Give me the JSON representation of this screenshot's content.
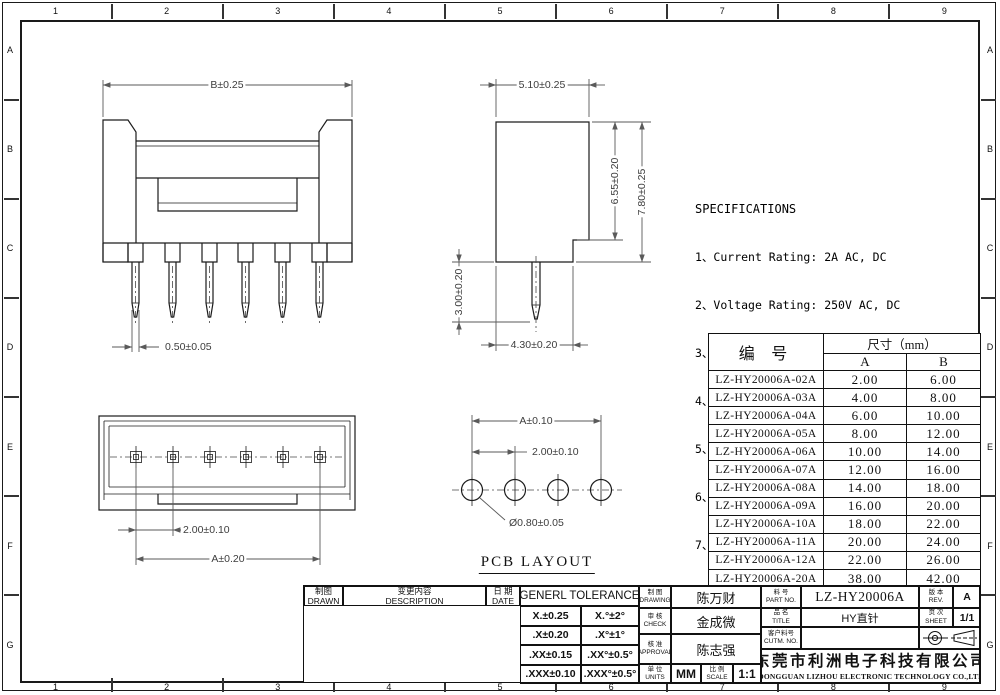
{
  "sheet": {
    "grid": {
      "columns": [
        "1",
        "2",
        "3",
        "4",
        "5",
        "6",
        "7",
        "8",
        "9"
      ],
      "rows": [
        "A",
        "B",
        "C",
        "D",
        "E",
        "F",
        "G"
      ]
    }
  },
  "views": {
    "front_view": {
      "dims": {
        "body_width": "B±0.25",
        "pin_width": "0.50±0.05"
      }
    },
    "side_view": {
      "dims": {
        "body_depth": "5.10±0.25",
        "inner_height": "6.55±0.20",
        "overall_height": "7.80±0.25",
        "pin_length": "3.00±0.20",
        "base_depth": "4.30±0.20"
      }
    },
    "top_view": {
      "dims": {
        "pin_pitch": "2.00±0.10",
        "pin_span": "A±0.20"
      }
    },
    "pcb_layout": {
      "label": "PCB LAYOUT",
      "dims": {
        "hole_span": "A±0.10",
        "hole_pitch": "2.00±0.10",
        "hole_diameter": "Ø0.80±0.05"
      }
    }
  },
  "specifications": {
    "title": "SPECIFICATIONS",
    "items": [
      "1、Current Rating: 2A AC, DC",
      "2、Voltage Rating: 250V AC, DC",
      "3、Temperatuer Range: -25℃~+85℃",
      "4、Contact Resistance: 20mΩ Max",
      "5、Insulation Resistance: 1000MΩ Min",
      "6、Withstanding Voltang: 1000V AC/minute",
      "7、Material:Wafer Nylon66,UL94V-0",
      "   PIN Brass Tin-plated"
    ]
  },
  "parts_table": {
    "header": {
      "part_no": "编  号",
      "size_group": "尺寸（mm）",
      "col_a": "A",
      "col_b": "B"
    },
    "rows": [
      {
        "part_no": "LZ-HY20006A-02A",
        "a": "2.00",
        "b": "6.00"
      },
      {
        "part_no": "LZ-HY20006A-03A",
        "a": "4.00",
        "b": "8.00"
      },
      {
        "part_no": "LZ-HY20006A-04A",
        "a": "6.00",
        "b": "10.00"
      },
      {
        "part_no": "LZ-HY20006A-05A",
        "a": "8.00",
        "b": "12.00"
      },
      {
        "part_no": "LZ-HY20006A-06A",
        "a": "10.00",
        "b": "14.00"
      },
      {
        "part_no": "LZ-HY20006A-07A",
        "a": "12.00",
        "b": "16.00"
      },
      {
        "part_no": "LZ-HY20006A-08A",
        "a": "14.00",
        "b": "18.00"
      },
      {
        "part_no": "LZ-HY20006A-09A",
        "a": "16.00",
        "b": "20.00"
      },
      {
        "part_no": "LZ-HY20006A-10A",
        "a": "18.00",
        "b": "22.00"
      },
      {
        "part_no": "LZ-HY20006A-11A",
        "a": "20.00",
        "b": "24.00"
      },
      {
        "part_no": "LZ-HY20006A-12A",
        "a": "22.00",
        "b": "26.00"
      },
      {
        "part_no": "LZ-HY20006A-20A",
        "a": "38.00",
        "b": "42.00"
      }
    ]
  },
  "title_block": {
    "revision": {
      "drawn_cn": "制图",
      "drawn_en": "DRAWN",
      "description_cn": "变更内容",
      "description_en": "DESCRIPTION",
      "date_cn": "日 期",
      "date_en": "DATE"
    },
    "tolerance": {
      "title": "GENERL TOLERANCE",
      "rows": [
        [
          "X.±0.25",
          "X.°±2°"
        ],
        [
          ".X±0.20",
          ".X°±1°"
        ],
        [
          ".XX±0.15",
          ".XX°±0.5°"
        ],
        [
          ".XXX±0.10",
          ".XXX°±0.5°"
        ]
      ]
    },
    "signoff": {
      "drawing_cn": "制 图",
      "drawing_en": "DRAWING",
      "drawing_name": "陈万财",
      "check_cn": "审 核",
      "check_en": "CHECK",
      "check_name": "金成微",
      "approval_cn": "核 准",
      "approval_en": "APPROVAL",
      "approval_name": "陈志强",
      "units_cn": "单 位",
      "units_en": "UNITS",
      "units_value": "MM",
      "scale_cn": "比 例",
      "scale_en": "SCALE",
      "scale_value": "1:1"
    },
    "part_info": {
      "part_no_cn": "料 号",
      "part_no_en": "PART NO.",
      "part_no": "LZ-HY20006A",
      "name_cn": "品 名",
      "name_en": "TITLE",
      "name_value": "HY直针",
      "customer_cn": "客户料号",
      "customer_en": "CUTM. NO.",
      "customer_value": "",
      "rev_cn": "版 本",
      "rev_en": "REV.",
      "rev_value": "A",
      "sheet_cn": "页 次",
      "sheet_en": "SHEET",
      "sheet_value": "1/1"
    },
    "company": {
      "cn": "东莞市利洲电子科技有限公司",
      "en": "DONGGUAN LIZHOU ELECTRONIC TECHNOLOGY CO.,LTD"
    }
  }
}
